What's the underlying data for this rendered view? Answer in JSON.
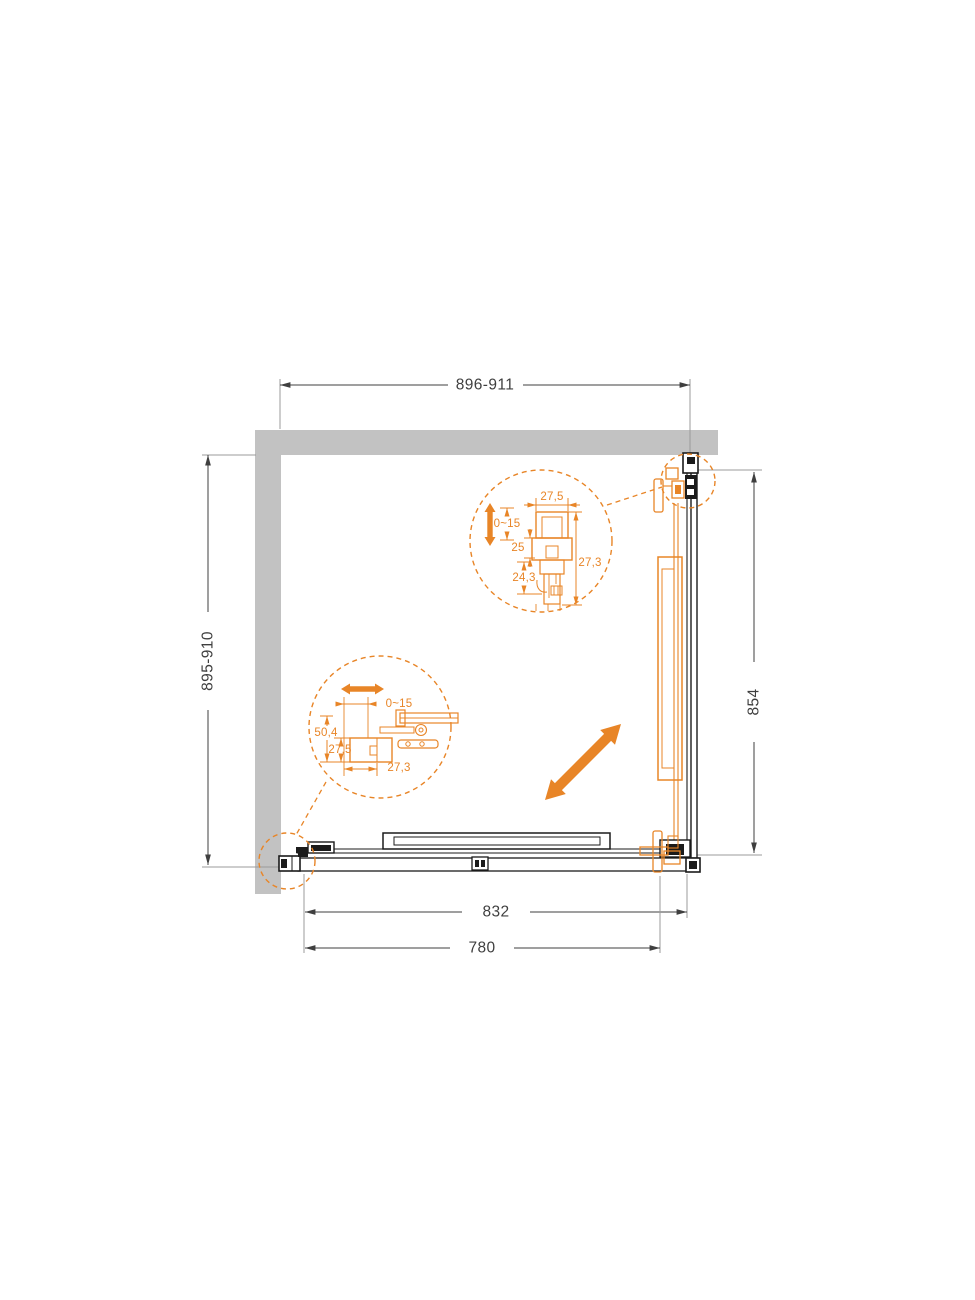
{
  "drawing": {
    "kind": "shower-enclosure-corner-plan",
    "colors": {
      "accent_orange": "#E88527",
      "wall_gray": "#C2C2C2",
      "line_black": "#1b1b1b",
      "dim_gray": "#3f3f3f"
    },
    "icons": {
      "slide_direction": "diagonal-double-arrow",
      "vertical_adjustment": "vertical-double-arrow",
      "horizontal_adjustment": "horizontal-double-arrow"
    }
  },
  "dimensions": {
    "top_width": "896-911",
    "left_depth": "895-910",
    "right_height": "854",
    "bottom_outer": "832",
    "bottom_inner": "780"
  },
  "detail_top": {
    "profile_width": "27,5",
    "adjustment_range": "0~15",
    "dim_25": "25",
    "dim_24_3": "24,3",
    "dim_27_3": "27,3"
  },
  "detail_bottom": {
    "adjustment_range": "0~15",
    "dim_50_4": "50,4",
    "dim_27_5": "27,5",
    "dim_27_3": "27,3"
  }
}
